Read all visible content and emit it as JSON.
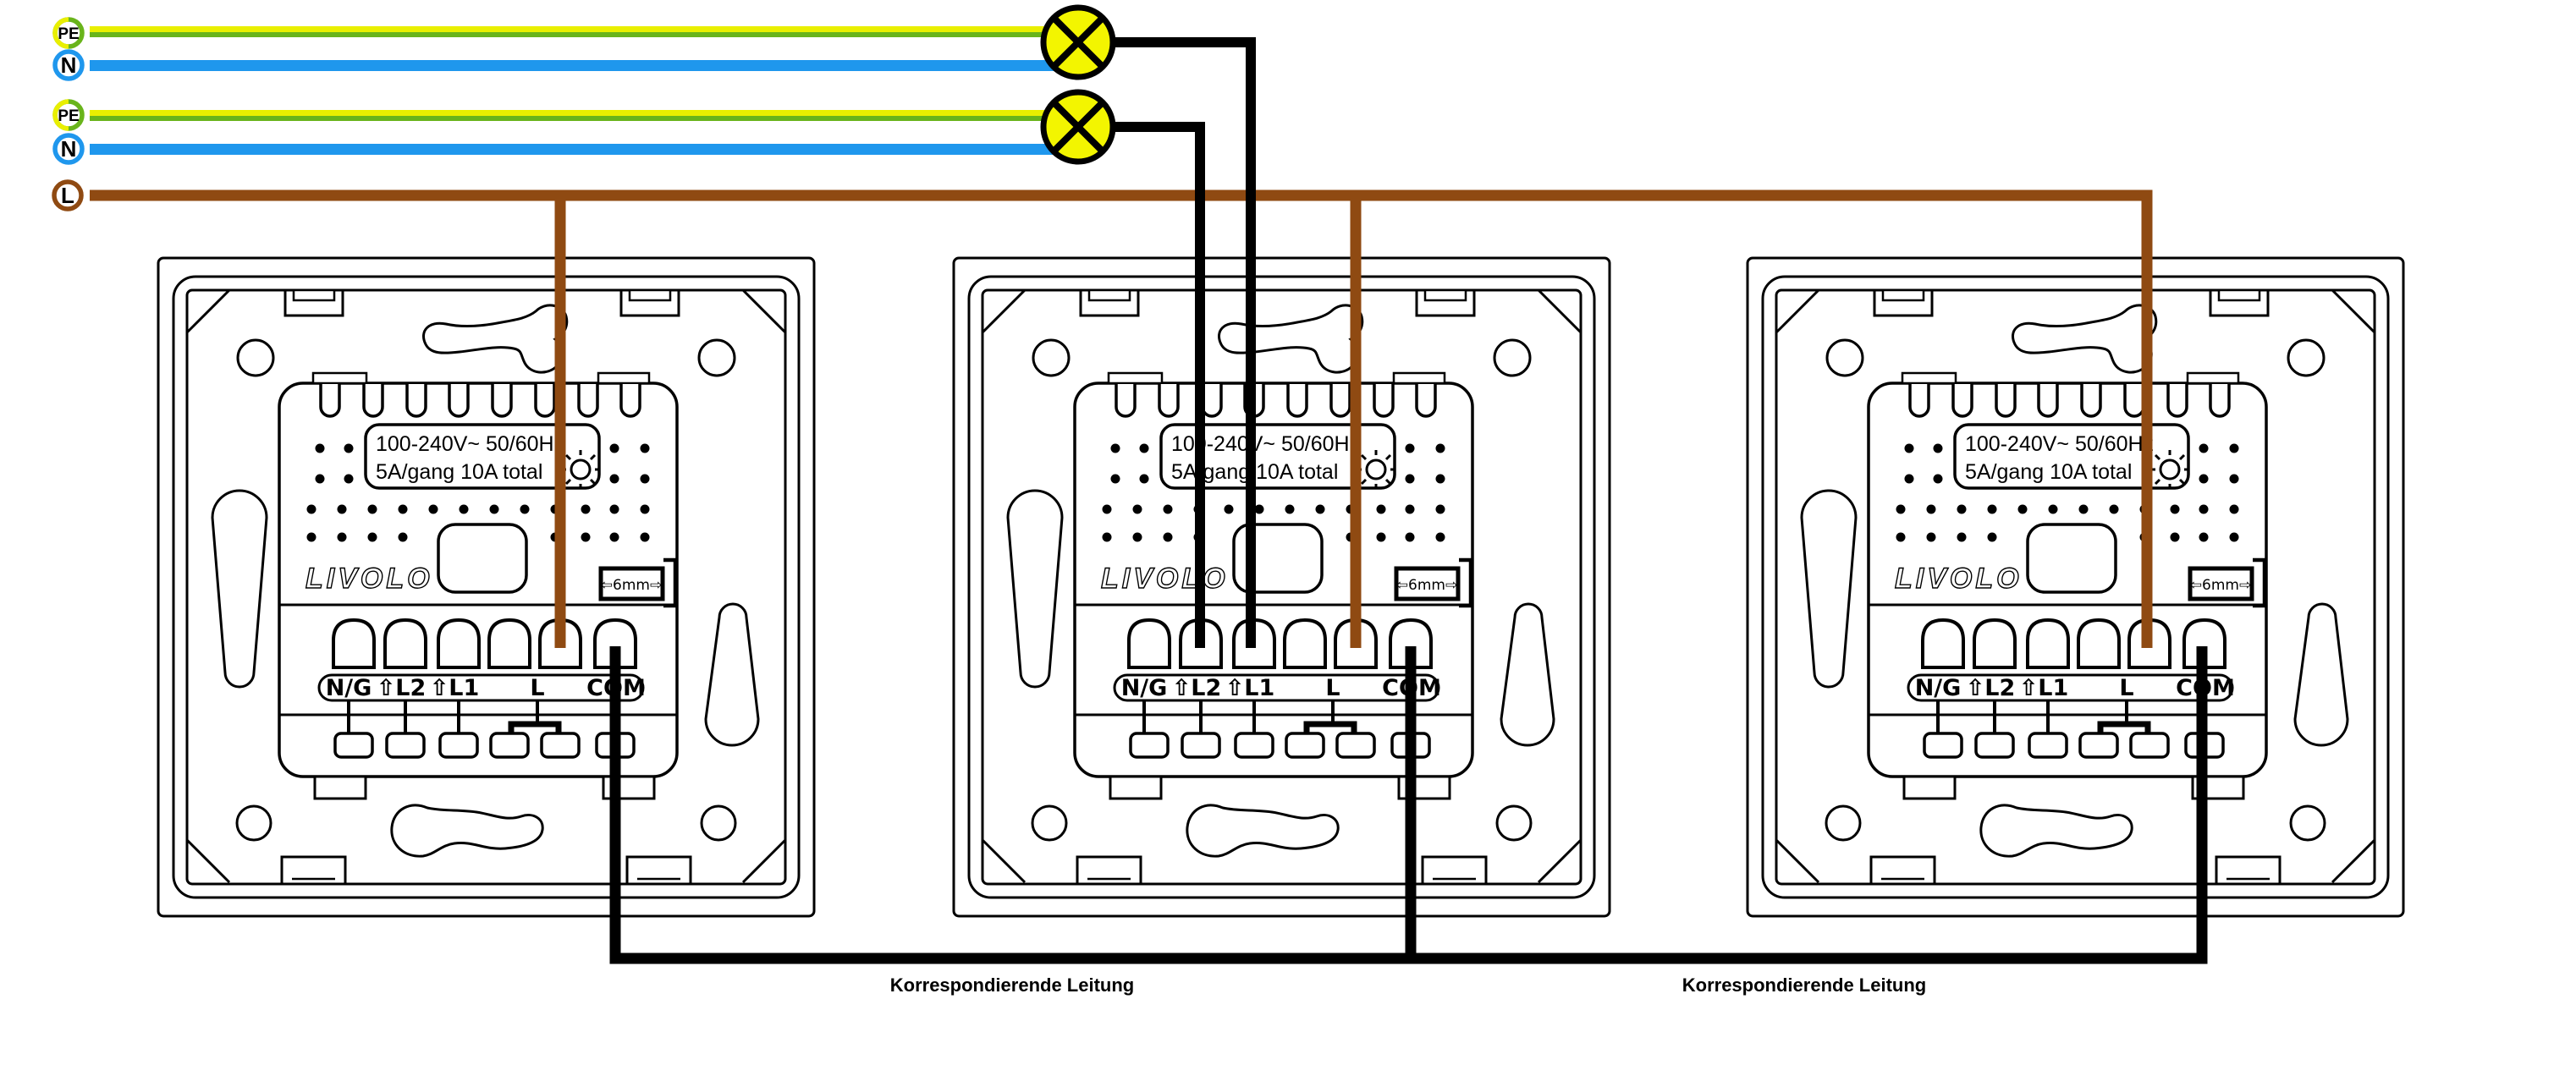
{
  "diagram": {
    "supply": {
      "badges": [
        {
          "id": "pe-1",
          "label": "PE"
        },
        {
          "id": "n-1",
          "label": "N"
        },
        {
          "id": "pe-2",
          "label": "PE"
        },
        {
          "id": "n-2",
          "label": "N"
        },
        {
          "id": "l",
          "label": "L"
        }
      ]
    },
    "switch": {
      "rating_line1": "100-240V~ 50/60Hz",
      "rating_line2": "5A/gang 10A total",
      "brand": "LIVOLO",
      "gauge_label": "⇦6mm⇨",
      "terminal_labels": [
        "N/G",
        "⇧L2",
        "⇧L1",
        "L",
        "COM"
      ]
    },
    "annotations": {
      "link1": "Korrespondierende Leitung",
      "link2": "Korrespondierende Leitung"
    },
    "colors": {
      "pe_yellow": "#e9ef00",
      "pe_green": "#69b41b",
      "neutral_blue": "#1f97ed",
      "live_brown": "#8f4a12",
      "lamp_yellow": "#f3f500",
      "wire_black": "#000000"
    }
  }
}
